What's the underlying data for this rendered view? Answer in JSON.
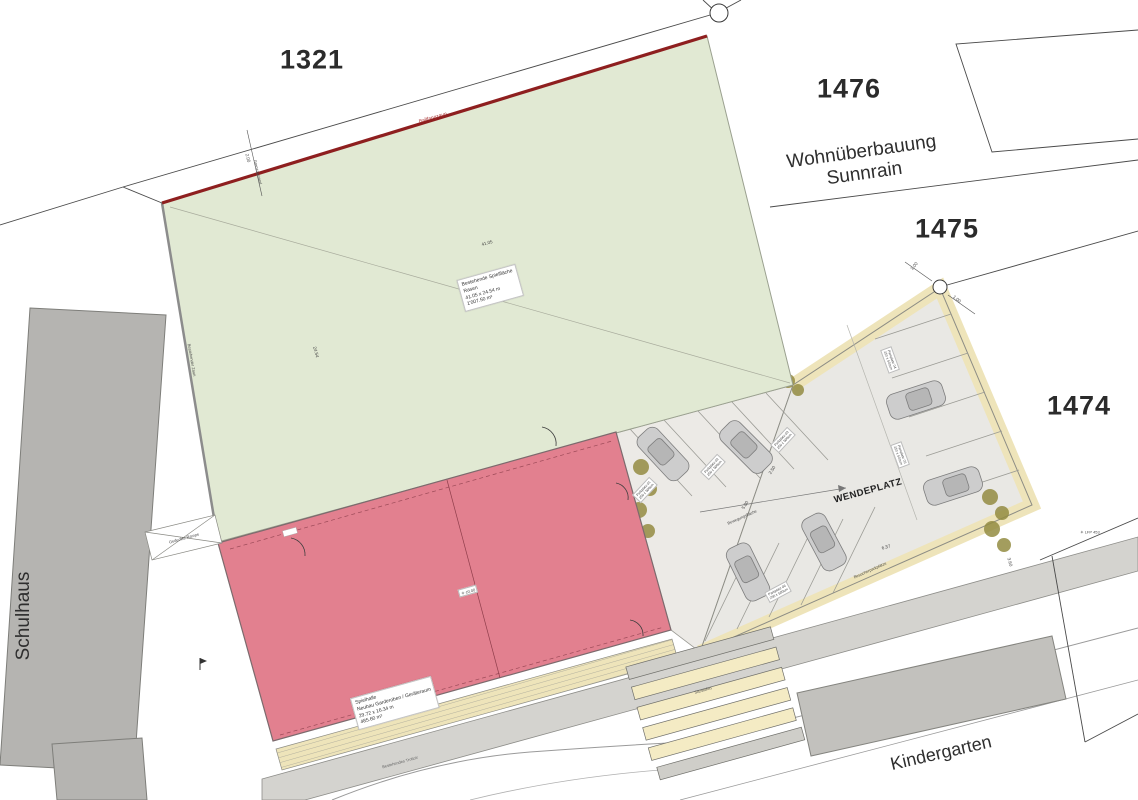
{
  "plan": {
    "parcels": {
      "field": "1321",
      "top_right": "1476",
      "mid_right": "1475",
      "lower_right": "1474"
    },
    "areas": {
      "development_line1": "Wohnüberbauung",
      "development_line2": "Sunnrain",
      "school": "Schulhaus",
      "kindergarten": "Kindergarten",
      "turning_area": "WENDEPLATZ"
    },
    "field_label": {
      "line1": "Bestehende Spielfläche",
      "line2": "Rasen",
      "line3": "41.05 x 24.54 m",
      "line4": "1'007.50 m²"
    },
    "hall_label": {
      "line1": "Spielhalle",
      "line2": "Neubau Garderoben / Geräteraum",
      "line3": "29.72 x 16.34 m",
      "line4": "485.60 m²"
    },
    "annotations": {
      "fence_red": "Ballfangzaun",
      "boundary_fence": "Bestehender Zaun",
      "ramp": "Gedeckte Rampe",
      "steps": "Sitzstufen",
      "sidewalk": "Bestehendes Trottoir",
      "visitor_parking": "Besucherparkplätze",
      "movement": "Bewegungsfläche",
      "setback": "Grenzabstand",
      "elevation": "✳ ±0.00",
      "fixpoint": "✳ LFP 453"
    },
    "parking_stalls": [
      {
        "name": "Parkplatz 01",
        "size": "250 x 500cm"
      },
      {
        "name": "Parkplatz 02",
        "size": "250 x 500cm"
      },
      {
        "name": "Parkplatz 03",
        "size": "250 x 500cm"
      },
      {
        "name": "Parkplatz 04",
        "size": "250 x 500cm"
      },
      {
        "name": "Parkplatz 05",
        "size": "250 x 500cm"
      },
      {
        "name": "Parkplatz 06",
        "size": "250 x 500cm"
      }
    ],
    "dimensions": {
      "field_width": "41.05",
      "field_depth": "24.54",
      "setback": "2.00",
      "turning": "6.37",
      "offset_a": "1.00",
      "offset_b": "1.00",
      "stall_width": "2.50",
      "lane": "5.00",
      "gap": "3.60"
    },
    "colors": {
      "field_green": "#e1e9d3",
      "hall_pink": "#e2808f",
      "fence_red_line": "#8e1f1f",
      "pavement_cream": "#eee4ba",
      "asphalt_gray": "#d4d3cf",
      "building_gray": "#b5b4b1"
    }
  }
}
